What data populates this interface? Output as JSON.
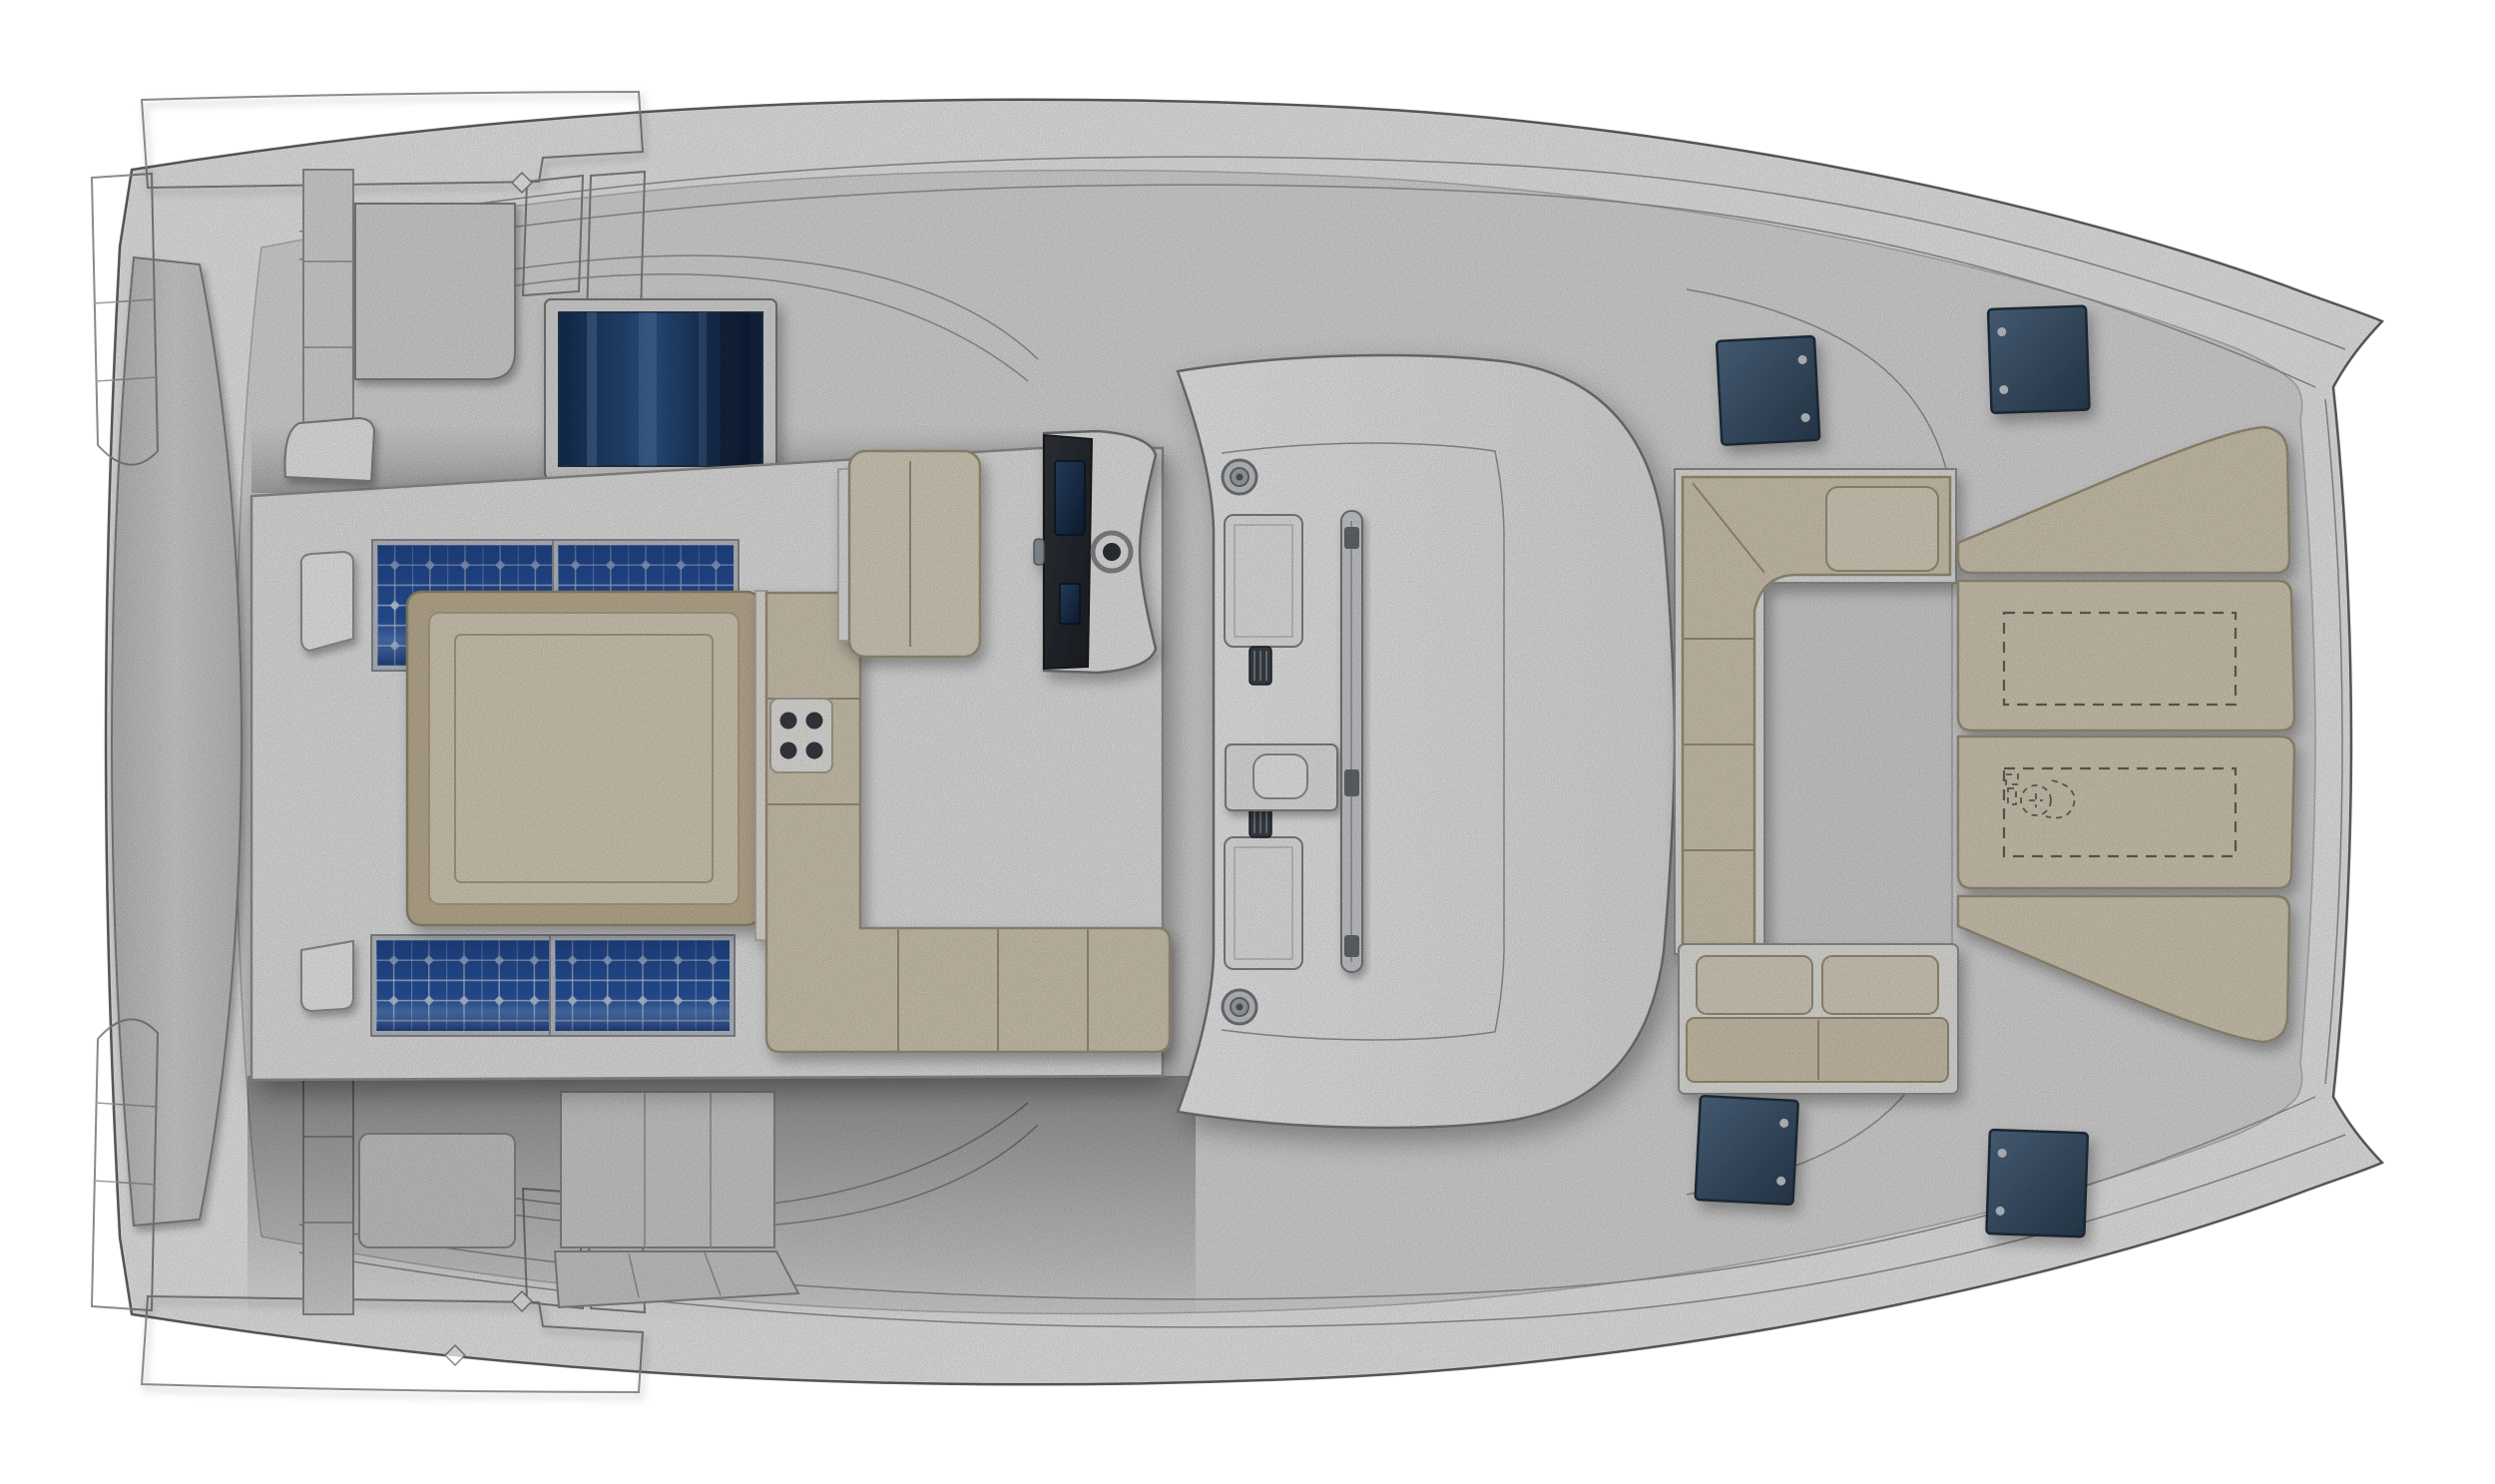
{
  "illustration": {
    "title": "Catamaran deck plan, top view, bow pointing right",
    "type": "boat-deck-layout",
    "counts": {
      "hull_bows": 2,
      "solar_panels": 4,
      "deck_hatches_dark": 4,
      "winches": 2,
      "helm_screens": 2,
      "roof_vents": 2,
      "bow_sunpad_panels": 4,
      "dashed_locker_outlines": 2,
      "stern_step_clusters": 2
    }
  },
  "colors": {
    "background": "#ffffff",
    "hull_white": "#fcfcfc",
    "deck_gray": "#e9e9e9",
    "flybridge_white": "#f4f4f4",
    "roof_white": "#fafafa",
    "footwell_gray": "#e2e2e2",
    "beam_gray": "#dadada",
    "step_gray": "#e6e6e6",
    "hatch_panel_gray": "#e4e4e4",
    "solar_blue": "#2a58a8",
    "solar_blue_dark": "#1c3f86",
    "glass_navy": "#1c3a63",
    "glass_stroke": "#25384f",
    "hatch_blue": "#3d556e",
    "cushion_beige": "#e0d6bf",
    "cushion_beige_light": "#e7dfcc",
    "sunpad_frame_tan": "#cdbd9f",
    "sunpad_field": "#e6dcc6",
    "cushion_base_white": "#f3f2ed",
    "teak_brown": "#8a6f4e",
    "console_carbon": "#24282d",
    "metal_gray": "#d2d5d9",
    "outline_gray": "#5f5f5f"
  }
}
